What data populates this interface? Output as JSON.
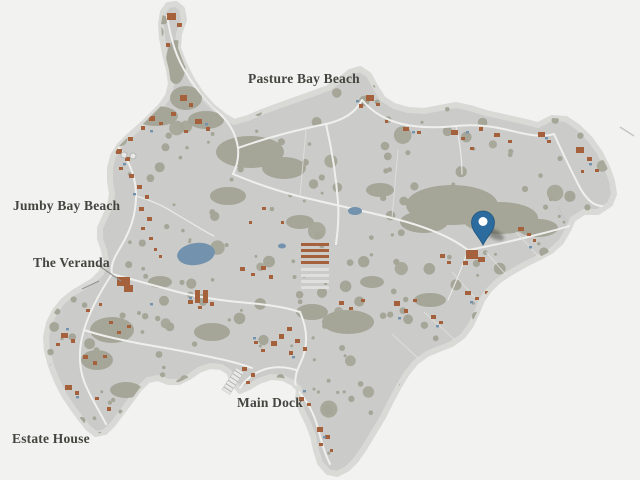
{
  "map": {
    "name": "Island resort map",
    "labels": [
      {
        "id": "pasture-bay-beach",
        "text": "Pasture Bay Beach"
      },
      {
        "id": "jumby-bay-beach",
        "text": "Jumby Bay Beach"
      },
      {
        "id": "the-veranda",
        "text": "The Veranda"
      },
      {
        "id": "main-dock",
        "text": "Main Dock"
      },
      {
        "id": "estate-house",
        "text": "Estate House"
      }
    ],
    "marker": {
      "name": "location-pin",
      "color": "#2c6b9d"
    },
    "colors": {
      "sea": "#f2f2f1",
      "beach": "#d9dad6",
      "land": "#cbccca",
      "vegetation": "#a5a598",
      "road": "#eff0ed",
      "building": "#a5613c",
      "water": "#7392ad",
      "pin": "#2c6b9d",
      "pin_dark": "#1f567f",
      "label_text": "#45453f",
      "leader": "#90908d"
    }
  }
}
